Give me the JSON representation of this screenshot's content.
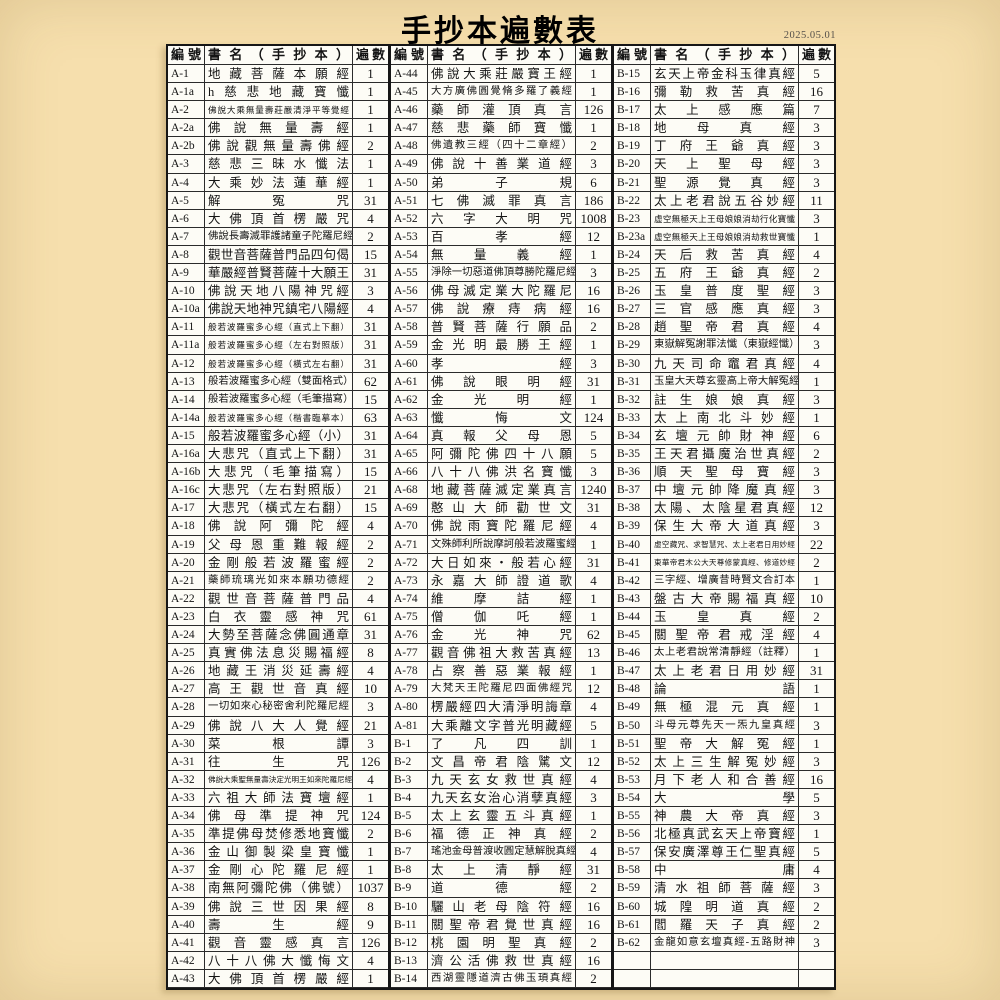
{
  "page": {
    "title": "手抄本遍數表",
    "date": "2025.05.01"
  },
  "table": {
    "headers": {
      "id": "編號",
      "name": "書名（手抄本）",
      "count": "遍數"
    },
    "row_fields": [
      "id",
      "name",
      "count"
    ],
    "columns": [
      [
        [
          "A-1",
          "地藏菩薩本願經",
          "1"
        ],
        [
          "A-1a",
          "h慈悲地藏寶懺",
          "1"
        ],
        [
          "A-2",
          "佛說大乘無量壽莊嚴清淨平等覺經",
          "1"
        ],
        [
          "A-2a",
          "佛說無量壽經",
          "1"
        ],
        [
          "A-2b",
          "佛說觀無量壽佛經",
          "2"
        ],
        [
          "A-3",
          "慈悲三昧水懺法",
          "1"
        ],
        [
          "A-4",
          "大乘妙法蓮華經",
          "1"
        ],
        [
          "A-5",
          "解冤咒",
          "31"
        ],
        [
          "A-6",
          "大佛頂首楞嚴咒",
          "4"
        ],
        [
          "A-7",
          "佛說長壽滅罪護諸童子陀羅尼經",
          "2"
        ],
        [
          "A-8",
          "觀世音菩薩普門品四句偈",
          "15"
        ],
        [
          "A-9",
          "華嚴經普賢菩薩十大願王",
          "31"
        ],
        [
          "A-10",
          "佛說天地八陽神咒經",
          "3"
        ],
        [
          "A-10a",
          "佛說天地神咒鎮宅八陽經",
          "4"
        ],
        [
          "A-11",
          "般若波羅蜜多心經（直式上下翻）",
          "31"
        ],
        [
          "A-11a",
          "般若波羅蜜多心經（左右對照版）",
          "31"
        ],
        [
          "A-12",
          "般若波羅蜜多心經（橫式左右翻）",
          "31"
        ],
        [
          "A-13",
          "般若波羅蜜多心經（雙面格式）",
          "62"
        ],
        [
          "A-14",
          "般若波羅蜜多心經（毛筆描寫）",
          "15"
        ],
        [
          "A-14a",
          "般若波羅蜜多心經（楷書臨摹本）",
          "63"
        ],
        [
          "A-15",
          "般若波羅蜜多心經（小）",
          "31"
        ],
        [
          "A-16a",
          "大悲咒（直式上下翻）",
          "31"
        ],
        [
          "A-16b",
          "大悲咒（毛筆描寫）",
          "15"
        ],
        [
          "A-16c",
          "大悲咒（左右對照版）",
          "21"
        ],
        [
          "A-17",
          "大悲咒（橫式左右翻）",
          "15"
        ],
        [
          "A-18",
          "佛說阿彌陀經",
          "4"
        ],
        [
          "A-19",
          "父母恩重難報經",
          "2"
        ],
        [
          "A-20",
          "金剛般若波羅蜜經",
          "2"
        ],
        [
          "A-21",
          "藥師琉璃光如來本願功德經",
          "2"
        ],
        [
          "A-22",
          "觀世音菩薩普門品",
          "4"
        ],
        [
          "A-23",
          "白衣靈感神咒",
          "61"
        ],
        [
          "A-24",
          "大勢至菩薩念佛圓通章",
          "31"
        ],
        [
          "A-25",
          "真實佛法息災賜福經",
          "8"
        ],
        [
          "A-26",
          "地藏王消災延壽經",
          "4"
        ],
        [
          "A-27",
          "高王觀世音真經",
          "10"
        ],
        [
          "A-28",
          "一切如來心秘密舍利陀羅尼經",
          "3"
        ],
        [
          "A-29",
          "佛說八大人覺經",
          "21"
        ],
        [
          "A-30",
          "菜根譚",
          "3"
        ],
        [
          "A-31",
          "往生咒",
          "126"
        ],
        [
          "A-32",
          "佛說大乘聖無量壽決定光明王如來陀羅尼經",
          "4"
        ],
        [
          "A-33",
          "六祖大師法寶壇經",
          "1"
        ],
        [
          "A-34",
          "佛母準提神咒",
          "124"
        ],
        [
          "A-35",
          "準提佛母焚修悉地寶懺",
          "2"
        ],
        [
          "A-36",
          "金山御製梁皇寶懺",
          "1"
        ],
        [
          "A-37",
          "金剛心陀羅尼經",
          "1"
        ],
        [
          "A-38",
          "南無阿彌陀佛（佛號）",
          "1037"
        ],
        [
          "A-39",
          "佛說三世因果經",
          "8"
        ],
        [
          "A-40",
          "壽生經",
          "9"
        ],
        [
          "A-41",
          "觀音靈感真言",
          "126"
        ],
        [
          "A-42",
          "八十八佛大懺悔文",
          "4"
        ],
        [
          "A-43",
          "大佛頂首楞嚴經",
          "1"
        ]
      ],
      [
        [
          "A-44",
          "佛說大乘莊嚴寶王經",
          "1"
        ],
        [
          "A-45",
          "大方廣佛圓覺脩多羅了義經",
          "1"
        ],
        [
          "A-46",
          "藥師灌頂真言",
          "126"
        ],
        [
          "A-47",
          "慈悲藥師寶懺",
          "1"
        ],
        [
          "A-48",
          "佛遺教三經（四十二章經）",
          "2"
        ],
        [
          "A-49",
          "佛說十善業道經",
          "3"
        ],
        [
          "A-50",
          "弟子規",
          "6"
        ],
        [
          "A-51",
          "七佛滅罪真言",
          "186"
        ],
        [
          "A-52",
          "六字大明咒",
          "1008"
        ],
        [
          "A-53",
          "百孝經",
          "12"
        ],
        [
          "A-54",
          "無量義經",
          "1"
        ],
        [
          "A-55",
          "淨除一切惡道佛頂尊勝陀羅尼經",
          "3"
        ],
        [
          "A-56",
          "佛母滅定業大陀羅尼",
          "16"
        ],
        [
          "A-57",
          "佛說療痔病經",
          "16"
        ],
        [
          "A-58",
          "普賢菩薩行願品",
          "2"
        ],
        [
          "A-59",
          "金光明最勝王經",
          "1"
        ],
        [
          "A-60",
          "孝經",
          "3"
        ],
        [
          "A-61",
          "佛說眼明經",
          "31"
        ],
        [
          "A-62",
          "金光明經",
          "1"
        ],
        [
          "A-63",
          "懺悔文",
          "124"
        ],
        [
          "A-64",
          "真報父母恩",
          "5"
        ],
        [
          "A-65",
          "阿彌陀佛四十八願",
          "5"
        ],
        [
          "A-66",
          "八十八佛洪名寶懺",
          "3"
        ],
        [
          "A-68",
          "地藏菩薩滅定業真言",
          "1240"
        ],
        [
          "A-69",
          "憨山大師勸世文",
          "31"
        ],
        [
          "A-70",
          "佛說雨寶陀羅尼經",
          "4"
        ],
        [
          "A-71",
          "文殊師利所說摩訶般若波羅蜜經",
          "1"
        ],
        [
          "A-72",
          "大日如來・般若心經",
          "31"
        ],
        [
          "A-73",
          "永嘉大師證道歌",
          "4"
        ],
        [
          "A-74",
          "維摩詰經",
          "1"
        ],
        [
          "A-75",
          "僧伽吒經",
          "1"
        ],
        [
          "A-76",
          "金光神咒",
          "62"
        ],
        [
          "A-77",
          "觀音佛祖大救苦真經",
          "13"
        ],
        [
          "A-78",
          "占察善惡業報經",
          "1"
        ],
        [
          "A-79",
          "大梵天王陀羅尼四面佛經咒",
          "12"
        ],
        [
          "A-80",
          "楞嚴經四大清淨明誨章",
          "4"
        ],
        [
          "A-81",
          "大乘離文字普光明藏經",
          "5"
        ],
        [
          "B-1",
          "了凡四訓",
          "1"
        ],
        [
          "B-2",
          "文昌帝君陰騭文",
          "12"
        ],
        [
          "B-3",
          "九天玄女救世真經",
          "4"
        ],
        [
          "B-4",
          "九天玄女治心消孽真經",
          "3"
        ],
        [
          "B-5",
          "太上玄靈五斗真經",
          "1"
        ],
        [
          "B-6",
          "福德正神真經",
          "2"
        ],
        [
          "B-7",
          "瑤池金母普渡收圓定慧解脫真經",
          "4"
        ],
        [
          "B-8",
          "太上清靜經",
          "31"
        ],
        [
          "B-9",
          "道德經",
          "2"
        ],
        [
          "B-10",
          "驪山老母陰符經",
          "16"
        ],
        [
          "B-11",
          "關聖帝君覺世真經",
          "16"
        ],
        [
          "B-12",
          "桃園明聖真經",
          "2"
        ],
        [
          "B-13",
          "濟公活佛救世真經",
          "16"
        ],
        [
          "B-14",
          "西湖靈隱道濟古佛玉頊真經",
          "2"
        ]
      ],
      [
        [
          "B-15",
          "玄天上帝金科玉律真經",
          "5"
        ],
        [
          "B-16",
          "彌勒救苦真經",
          "16"
        ],
        [
          "B-17",
          "太上感應篇",
          "7"
        ],
        [
          "B-18",
          "地母真經",
          "3"
        ],
        [
          "B-19",
          "丁府王爺真經",
          "3"
        ],
        [
          "B-20",
          "天上聖母經",
          "3"
        ],
        [
          "B-21",
          "聖源覺真經",
          "3"
        ],
        [
          "B-22",
          "太上老君說五谷妙經",
          "11"
        ],
        [
          "B-23",
          "虛空無極天上王母娘娘消劫行化寶懺",
          "3"
        ],
        [
          "B-23a",
          "虛空無極天上王母娘娘消劫救世寶懺",
          "1"
        ],
        [
          "B-24",
          "天后救苦真經",
          "4"
        ],
        [
          "B-25",
          "五府王爺真經",
          "2"
        ],
        [
          "B-26",
          "玉皇普度聖經",
          "3"
        ],
        [
          "B-27",
          "三官感應真經",
          "3"
        ],
        [
          "B-28",
          "趙聖帝君真經",
          "4"
        ],
        [
          "B-29",
          "東嶽解冤謝罪法懺（東嶽經懺）",
          "3"
        ],
        [
          "B-30",
          "九天司命竈君真經",
          "4"
        ],
        [
          "B-31",
          "玉皇大天尊玄靈高上帝大解冤經",
          "1"
        ],
        [
          "B-32",
          "註生娘娘真經",
          "3"
        ],
        [
          "B-33",
          "太上南北斗妙經",
          "1"
        ],
        [
          "B-34",
          "玄壇元帥財神經",
          "6"
        ],
        [
          "B-35",
          "王天君攝魔治世真經",
          "2"
        ],
        [
          "B-36",
          "順天聖母寶經",
          "3"
        ],
        [
          "B-37",
          "中壇元帥降魔真經",
          "3"
        ],
        [
          "B-38",
          "太陽、太陰星君真經",
          "12"
        ],
        [
          "B-39",
          "保生大帝大道真經",
          "3"
        ],
        [
          "B-40",
          "虛空藏咒、求智慧咒、太上老君日用妙經",
          "22"
        ],
        [
          "B-41",
          "東華帝君木公大天尊修蒙真經、修道妙經",
          "2"
        ],
        [
          "B-42",
          "三字經、增廣昔時賢文合訂本",
          "1"
        ],
        [
          "B-43",
          "盤古大帝賜福真經",
          "10"
        ],
        [
          "B-44",
          "玉皇真經",
          "2"
        ],
        [
          "B-45",
          "關聖帝君戒淫經",
          "4"
        ],
        [
          "B-46",
          "太上老君說常清靜經（註釋）",
          "1"
        ],
        [
          "B-47",
          "太上老君日用妙經",
          "31"
        ],
        [
          "B-48",
          "論語",
          "1"
        ],
        [
          "B-49",
          "無極混元真經",
          "1"
        ],
        [
          "B-50",
          "斗母元尊先天一炁九皇真經",
          "3"
        ],
        [
          "B-51",
          "聖帝大解冤經",
          "1"
        ],
        [
          "B-52",
          "太上三生解冤妙經",
          "3"
        ],
        [
          "B-53",
          "月下老人和合善經",
          "16"
        ],
        [
          "B-54",
          "大學",
          "5"
        ],
        [
          "B-55",
          "神農大帝真經",
          "3"
        ],
        [
          "B-56",
          "北極真武玄天上帝寶經",
          "1"
        ],
        [
          "B-57",
          "保安廣澤尊王仁聖真經",
          "5"
        ],
        [
          "B-58",
          "中庸",
          "4"
        ],
        [
          "B-59",
          "清水祖師菩薩經",
          "3"
        ],
        [
          "B-60",
          "城隍明道真經",
          "2"
        ],
        [
          "B-61",
          "閻羅天子真經",
          "2"
        ],
        [
          "B-62",
          "金龍如意玄壇真經-五路財神",
          "3"
        ],
        [
          "",
          "",
          ""
        ],
        [
          "",
          "",
          ""
        ]
      ]
    ]
  }
}
